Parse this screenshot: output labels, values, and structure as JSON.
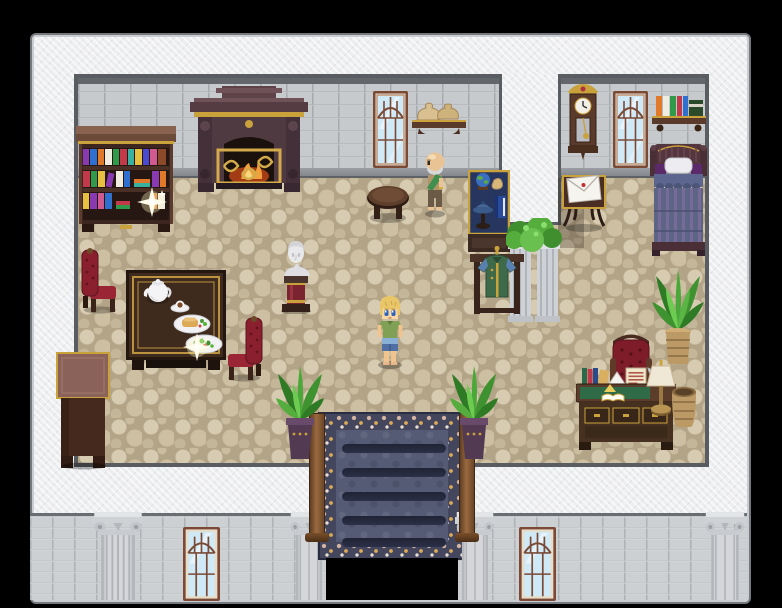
{
  "scene": {
    "label": "RPG interior scene - mansion hall with study, dining corner and bedroom",
    "viewport": {
      "width": 782,
      "height": 608
    },
    "characters": {
      "player": {
        "label": "Player character (blond hair, green shirt, blue shorts)"
      },
      "npc_old_man": {
        "label": "Elderly bald man with gray beard and green sash"
      }
    },
    "interactables": {
      "bookshelf_sparkle": {
        "label": "Sparkling item on bookshelf"
      },
      "table_sparkle": {
        "label": "Sparkling item on dining table plate"
      },
      "stairs_down": {
        "label": "Carpeted staircase leading down"
      },
      "letter_table": {
        "label": "Letter on small table"
      }
    },
    "furniture": {
      "left_room": [
        "bookshelf",
        "fireplace",
        "arched window",
        "wall shelf with coin sacks",
        "round side table",
        "dining table with tea set and meals",
        "red armchairs",
        "marble bust on pedestal",
        "side cabinet",
        "display case with globe and cap",
        "clothes stand with green coat",
        "ivy-topped marble columns",
        "potted plants"
      ],
      "right_room": [
        "grandfather clock",
        "arched window",
        "wall shelf with books",
        "bed with violet striped quilt",
        "writing desk with lamp, books and note",
        "red desk chair",
        "wicker basket",
        "tall potted plant"
      ]
    },
    "palette": {
      "void": "#000000",
      "outer_wall": "#edeef0",
      "brick_wall": "#c6cacd",
      "floor": "#c3b597",
      "carpet_border": "#43465c",
      "carpet_field": "#555b75",
      "accent_gold": "#c9a23c",
      "chair_red": "#8a1f2d",
      "plant_green": "#4aa838",
      "wood_dark": "#4a3326"
    }
  }
}
